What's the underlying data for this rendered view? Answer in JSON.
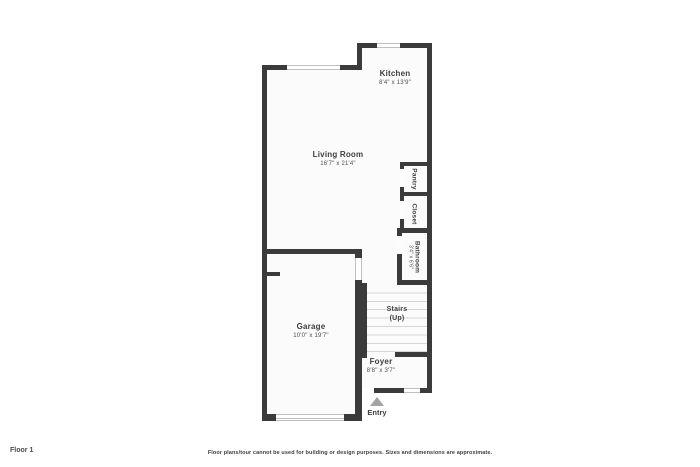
{
  "page": {
    "floor_label": "Floor 1",
    "disclaimer": "Floor plans/tour cannot be used for building or design purposes. Sizes and dimensions are approximate."
  },
  "rooms": {
    "kitchen": {
      "name": "Kitchen",
      "dims": "8'4\" x 13'9\""
    },
    "living_room": {
      "name": "Living Room",
      "dims": "16'7\" x 21'4\""
    },
    "pantry": {
      "name": "Pantry"
    },
    "closet": {
      "name": "Closet"
    },
    "bathroom": {
      "name": "Bathroom",
      "dims": "3'4\" x 6'6\""
    },
    "stairs": {
      "name": "Stairs",
      "direction": "(Up)"
    },
    "garage": {
      "name": "Garage",
      "dims": "10'0\" x 19'7\""
    },
    "foyer": {
      "name": "Foyer",
      "dims": "8'8\" x 3'7\""
    },
    "entry": {
      "label": "Entry"
    }
  },
  "colors": {
    "wall": "#3b3b3b",
    "floor": "#fbfbfb",
    "background": "#ffffff",
    "window_line": "#c0c0c0",
    "stair_tread": "#d6d6d6",
    "entry_arrow": "#a3a3a3",
    "label_text": "#3e3e3e"
  }
}
